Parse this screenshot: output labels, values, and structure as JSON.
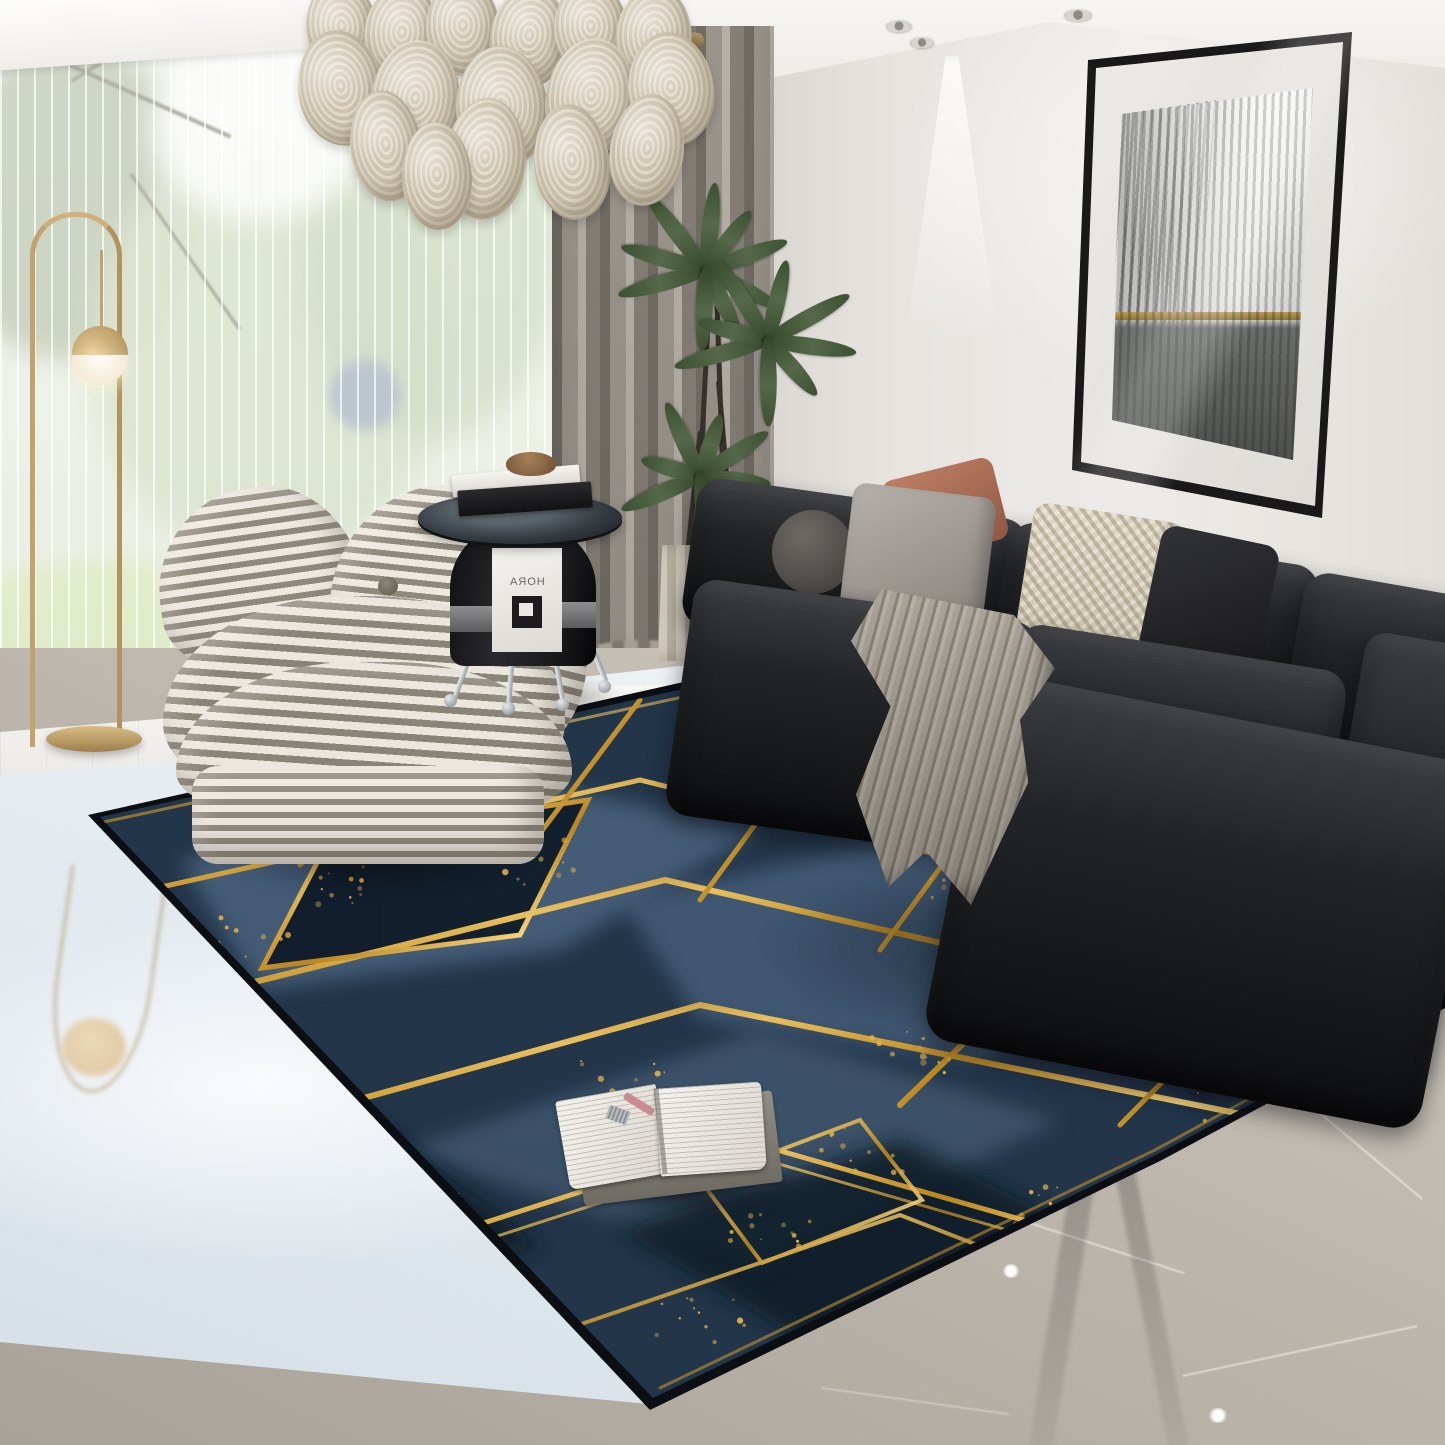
{
  "scene": {
    "type": "interior product photograph",
    "setting": "modern living room with floor-to-ceiling window, black leather modular sofa and a navy-blue rug with gold geometric lines on polished marble floor",
    "style": "photorealistic render, daylight"
  },
  "palette": {
    "wall": "#e8e5e1",
    "ceiling": "#f4f2ef",
    "curtain": "#9b958d",
    "sheer": "#eef0ea",
    "window-green": "#dfe8d6",
    "brass": "#c2a370",
    "rug-navy": "#223549",
    "rug-dark": "#0e1826",
    "rug-slate": "#4e6681",
    "gold": "#c79a33",
    "gold-bright": "#f0cd6a",
    "leather": "#1f2022",
    "terracotta": "#b3735a",
    "gray-pillow": "#a09b95",
    "knit": "#dcd3bf",
    "blanket": "#a59e94",
    "cream-stripe": "#eee9df",
    "gray-stripe": "#8f887c",
    "wood-pot": "#c9c2b4",
    "leaf-green": "#4f6347",
    "frame-black": "#191919",
    "marble-gray": "#b7b1a8",
    "floor-bright": "#e9eef2"
  },
  "objects": {
    "window": {
      "position": "left wall",
      "view": "sunlit trees and lawn",
      "covering": "white vertical-striped sheer"
    },
    "gray_curtain": {
      "position": "right side of window",
      "color_name": "warm gray",
      "state": "drawn, pooling on floor"
    },
    "chandelier": {
      "style": "layered oval shell discs on brass frame",
      "disc_count": 16,
      "color_name": "cream"
    },
    "ceiling_lights": {
      "type": "recessed downlights",
      "count": 3,
      "wall_glow_cones": 2
    },
    "floor_lamp": {
      "style": "brass arc with globe shade",
      "shade": "gold top hemisphere, frosted glowing bottom",
      "base": "round brass disc"
    },
    "armchair": {
      "style": "curvy lounge chair",
      "pattern": "horizontal cream and gray stripes"
    },
    "side_table": {
      "style": "round black table with arched magazine body and chrome casters",
      "poster_text": "HORA",
      "top_items": [
        "white book",
        "black book",
        "small wooden bowl"
      ]
    },
    "potted_plant": {
      "pot": "square light-wood planter",
      "foliage": "three rosettes of long dark-green leaves on thin dark stems"
    },
    "sofa": {
      "type": "black leather modular sectional with right chaise",
      "modules": 3,
      "pillows": [
        "round dark-gray ball",
        "terracotta",
        "light gray",
        "cream chunky-knit",
        "black leather"
      ],
      "blanket": "gray ribbed knit draped over middle seat"
    },
    "wall_art": {
      "frame": "thin black frame with wide white mat",
      "subject": "black-and-white architectural photo of curved building over water with gold waterline strip",
      "position": "right wall above sofa"
    },
    "rug": {
      "base_colors": [
        "navy",
        "ink blue",
        "slate blue"
      ],
      "pattern": "art-deco gold lines, diamonds and chevrons with gold-dust speckles",
      "edge": "dark binding"
    },
    "open_book": {
      "state": "open on rug atop closed gray book",
      "page_color": "white",
      "ribbon_color": "pink"
    },
    "floor": {
      "left": "high-gloss marble reflecting window and lamp",
      "right": "gray marble with white veins reflecting the wall art"
    }
  }
}
